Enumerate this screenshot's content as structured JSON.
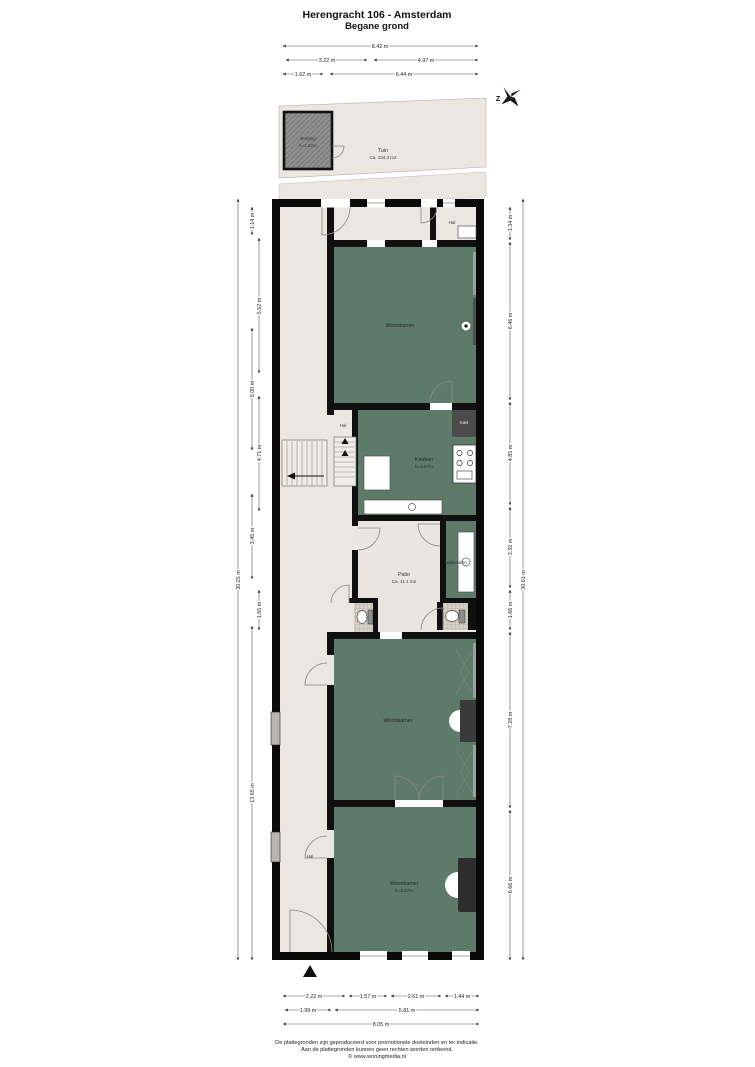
{
  "title": {
    "line1": "Herengracht 106 - Amsterdam",
    "line2": "Begane grond"
  },
  "compass": {
    "letter": "Z"
  },
  "garden": {
    "tuin": {
      "name": "Tuin",
      "area": "Ca. 104.3 m2"
    },
    "berging": {
      "name": "Berging",
      "height": "h=1.92m"
    }
  },
  "rooms": {
    "hal_top": "Hal",
    "woonkamer_1": "Woonkamer",
    "hal_mid": "Hal",
    "keuken": {
      "name": "Keuken",
      "height": "h=2.87m"
    },
    "kast": "Kast",
    "patio": {
      "name": "Patio",
      "area": "Ca. 11.1 m2"
    },
    "bijkeuken": "Bijkeuken",
    "woonkamer_2": "Woonkamer",
    "hal_bottom": "Hal",
    "woonkamer_3": {
      "name": "Woonkamer",
      "height": "h=4.17m"
    }
  },
  "dimensions": {
    "top": [
      "8.42 m",
      "3.22 m",
      "4.97 m",
      "1.62 m",
      "6.44 m"
    ],
    "bottom": [
      "2.22 m",
      "1.57 m",
      "2.61 m",
      "1.44 m",
      "1.99 m",
      "5.81 m",
      "8.05 m"
    ],
    "left": [
      "1.14 m",
      "5.52 m",
      "5.00 m",
      "4.71 m",
      "3.45 m",
      "1.65 m",
      "13.65 m",
      "30.25 m"
    ],
    "right": [
      "1.34 m",
      "6.46 m",
      "4.85 m",
      "3.32 m",
      "1.66 m",
      "7.28 m",
      "6.66 m",
      "30.61 m"
    ]
  },
  "footer": {
    "line1": "De plattegronden zijn geproduceerd voor promotionele doeleinden en ter indicatie.",
    "line2": "Aan de plattegronden kunnen geen rechten worden ontleend.",
    "line3": "© www.woningmedia.nl"
  },
  "colors": {
    "room_green": "#5e7a69",
    "floor_beige": "#eae6e0",
    "wall_black": "#101010",
    "berging_gray": "#8f8f8f"
  }
}
